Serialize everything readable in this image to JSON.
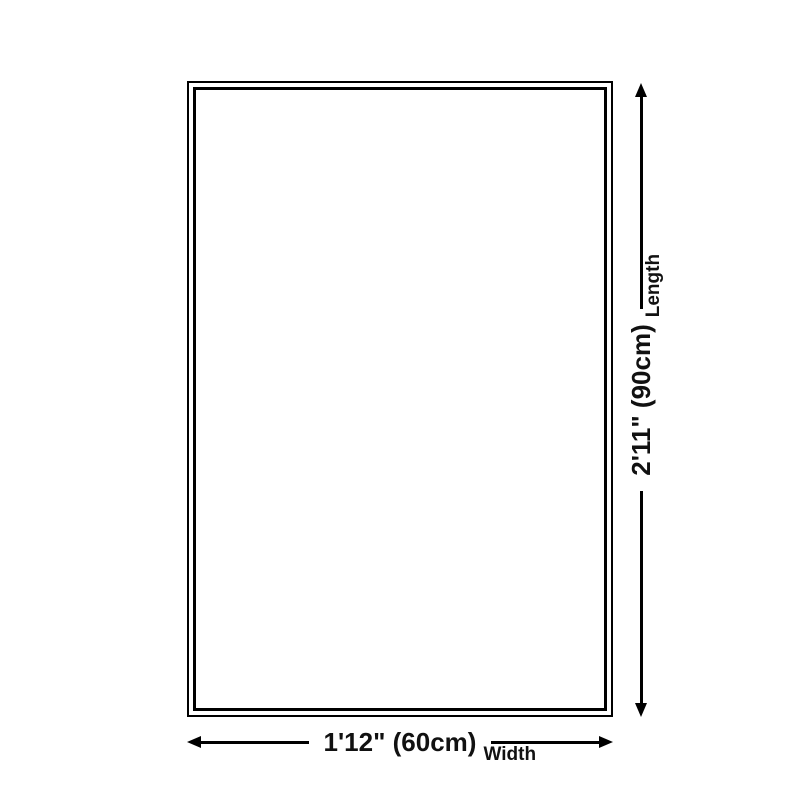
{
  "colors": {
    "bg": "#ffffff",
    "line": "#000000",
    "text": "#111111"
  },
  "dimensions": {
    "vertical": {
      "value": "2'11\" (90cm)",
      "label": "Length"
    },
    "horizontal": {
      "value": "1'12\" (60cm)",
      "label": "Width"
    }
  }
}
